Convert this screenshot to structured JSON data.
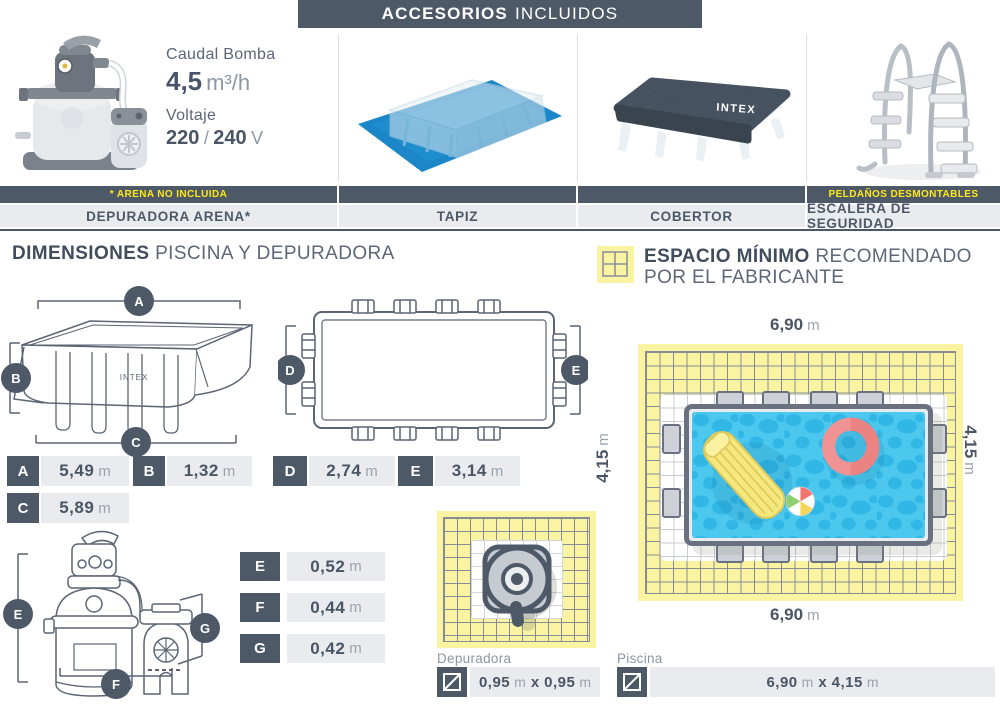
{
  "header": {
    "bold": "ACCESORIOS",
    "light": "INCLUIDOS"
  },
  "specs": {
    "flow_label": "Caudal Bomba",
    "flow_value": "4,5",
    "flow_unit": "m³/h",
    "volt_label": "Voltaje",
    "volt_v1": "220",
    "volt_sep": "/",
    "volt_v2": "240",
    "volt_unit": "V"
  },
  "accessory_notes": {
    "arena": "* ARENA NO INCLUIDA",
    "peldanos": "PELDAÑOS DESMONTABLES"
  },
  "accessory_labels": {
    "depuradora": "DEPURADORA ARENA*",
    "tapiz": "TAPIZ",
    "cobertor": "COBERTOR",
    "escalera": "ESCALERA DE SEGURIDAD"
  },
  "brand": "INTEX",
  "dimensions": {
    "title_bold": "DIMENSIONES",
    "title_light": "PISCINA Y DEPURADORA",
    "drawing_badges": {
      "a": "A",
      "b": "B",
      "c": "C",
      "d": "D",
      "e": "E",
      "f": "F",
      "g": "G"
    },
    "pool": [
      {
        "letter": "A",
        "value": "5,49",
        "unit": "m"
      },
      {
        "letter": "B",
        "value": "1,32",
        "unit": "m"
      },
      {
        "letter": "D",
        "value": "2,74",
        "unit": "m"
      },
      {
        "letter": "E",
        "value": "3,14",
        "unit": "m"
      },
      {
        "letter": "C",
        "value": "5,89",
        "unit": "m"
      }
    ],
    "pump": [
      {
        "letter": "E",
        "value": "0,52",
        "unit": "m"
      },
      {
        "letter": "F",
        "value": "0,44",
        "unit": "m"
      },
      {
        "letter": "G",
        "value": "0,42",
        "unit": "m"
      }
    ]
  },
  "min_space": {
    "title_bold": "ESPACIO MÍNIMO",
    "title_light1": "RECOMENDADO",
    "title_light2": "POR EL FABRICANTE",
    "width_value": "6,90",
    "height_value": "4,15",
    "unit": "m"
  },
  "footprints": {
    "depuradora": {
      "label": "Depuradora",
      "v1": "0,95",
      "u1": "m",
      "sep": "x",
      "v2": "0,95",
      "u2": "m"
    },
    "piscina": {
      "label": "Piscina",
      "v1": "6,90",
      "u1": "m",
      "sep": "x",
      "v2": "4,15",
      "u2": "m"
    }
  },
  "colors": {
    "slate": "#4e5968",
    "label_bg": "#e9ebef",
    "note_yellow": "#ffe81a",
    "grid_yellow": "#f9f3a2",
    "water_blue": "#4cc8ef",
    "tarp_blue": "#1b86c8"
  }
}
